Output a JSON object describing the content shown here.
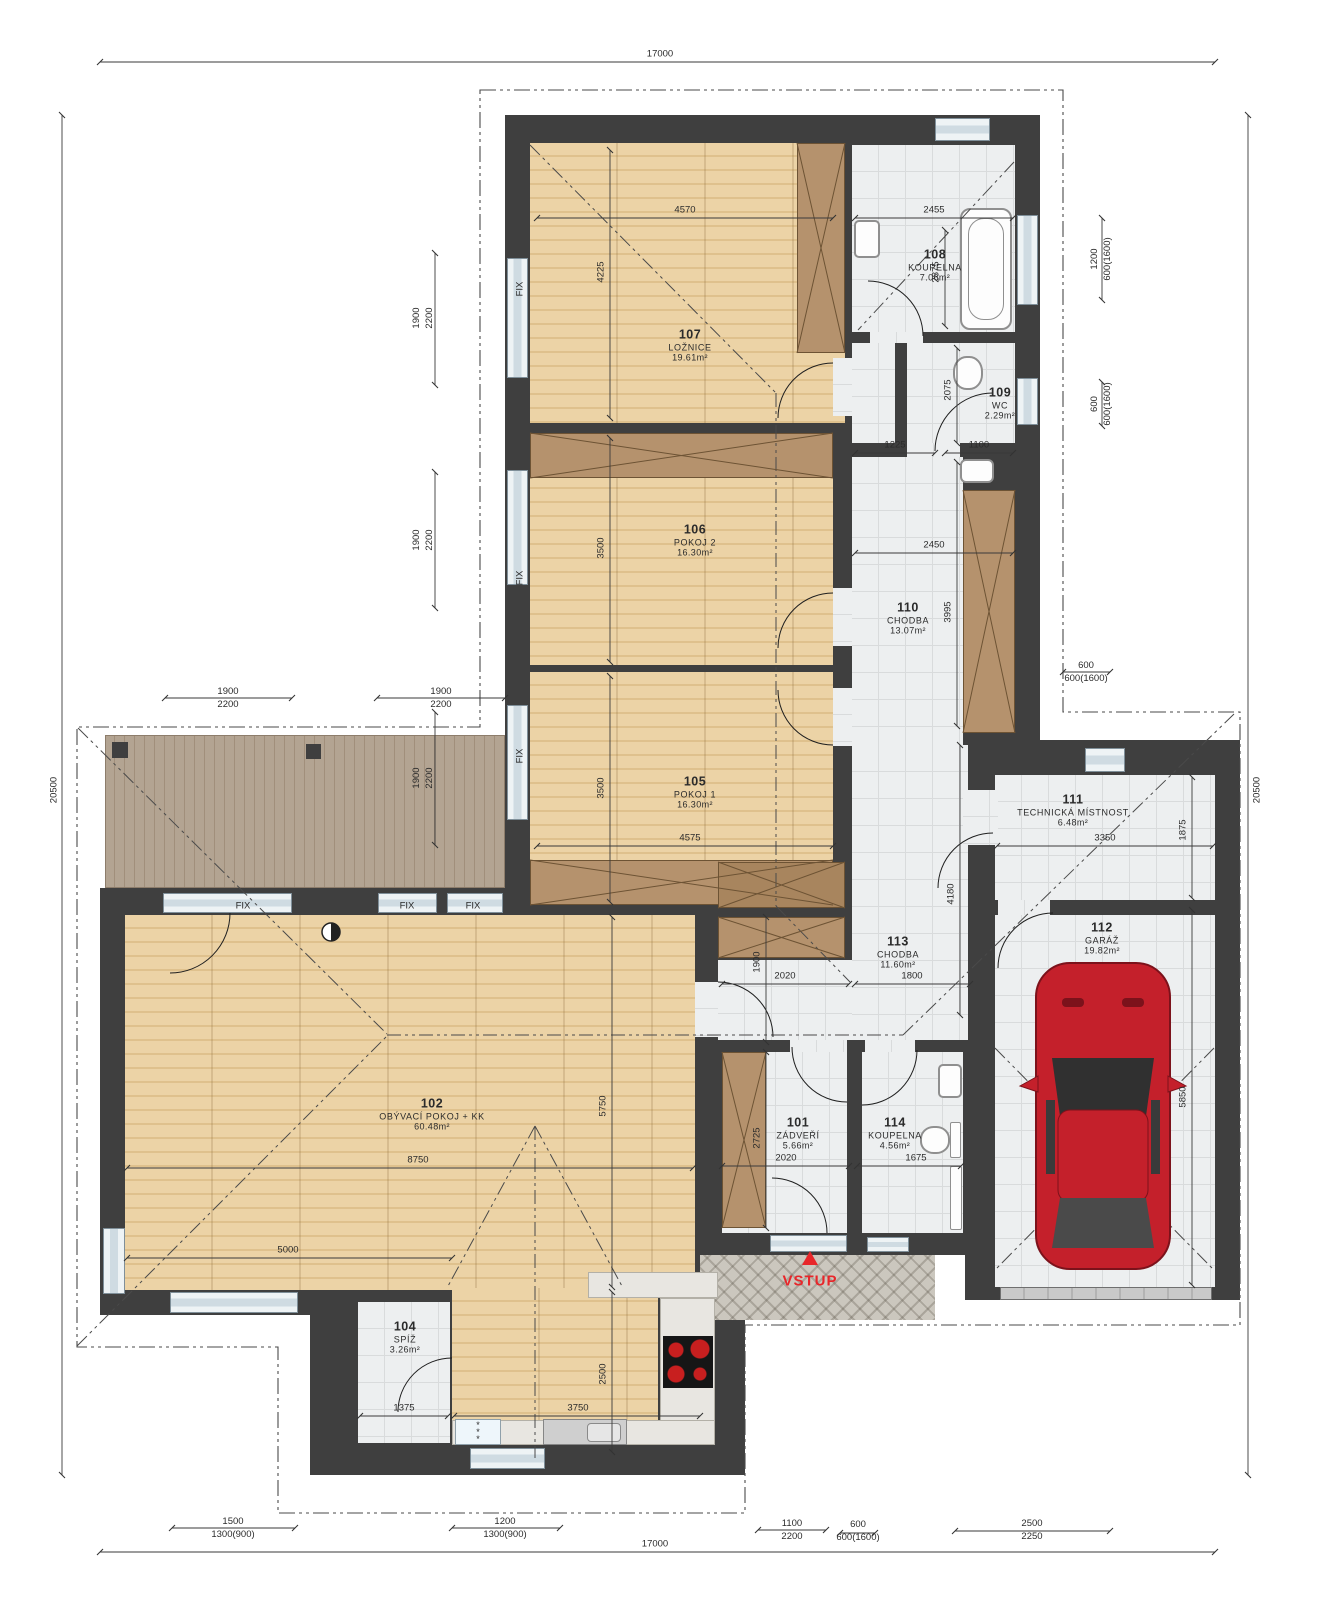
{
  "labels": {
    "fix": "FIX",
    "entry": "VSTUP",
    "fridge": "* * *"
  },
  "rooms": [
    {
      "num": "101",
      "name": "ZÁDVEŘÍ",
      "area": "5.66m²"
    },
    {
      "num": "102",
      "name": "OBÝVACÍ POKOJ + KK",
      "area": "60.48m²"
    },
    {
      "num": "104",
      "name": "SPÍŽ",
      "area": "3.26m²"
    },
    {
      "num": "105",
      "name": "POKOJ 1",
      "area": "16.30m²"
    },
    {
      "num": "106",
      "name": "POKOJ 2",
      "area": "16.30m²"
    },
    {
      "num": "107",
      "name": "LOŽNICE",
      "area": "19.61m²"
    },
    {
      "num": "108",
      "name": "KOUPELNA",
      "area": "7.06m²"
    },
    {
      "num": "109",
      "name": "WC",
      "area": "2.29m²"
    },
    {
      "num": "110",
      "name": "CHODBA",
      "area": "13.07m²"
    },
    {
      "num": "111",
      "name": "TECHNICKÁ MÍSTNOST",
      "area": "6.48m²"
    },
    {
      "num": "112",
      "name": "GARÁŽ",
      "area": "19.82m²"
    },
    {
      "num": "113",
      "name": "CHODBA",
      "area": "11.60m²"
    },
    {
      "num": "114",
      "name": "KOUPELNA",
      "area": "4.56m²"
    }
  ],
  "dims": {
    "overall": {
      "top": "17000",
      "bottom": "17000",
      "left": "20500",
      "right": "20500"
    },
    "interior": [
      "4570",
      "4225",
      "2455",
      "2875",
      "2075",
      "1225",
      "1100",
      "3500",
      "2450",
      "3995",
      "3500",
      "4575",
      "3350",
      "1875",
      "4180",
      "1900",
      "2020",
      "1800",
      "5850",
      "8750",
      "5750",
      "5000",
      "2725",
      "2020",
      "1675",
      "1375",
      "3750",
      "2500"
    ],
    "stacked": [
      {
        "a": "1900",
        "b": "2200"
      },
      {
        "a": "1900",
        "b": "2200"
      },
      {
        "a": "1900",
        "b": "2200"
      },
      {
        "a": "1900",
        "b": "2200"
      },
      {
        "a": "1900",
        "b": "2200"
      },
      {
        "a": "1200",
        "b": "600(1600)"
      },
      {
        "a": "600",
        "b": "600(1600)"
      },
      {
        "a": "600",
        "b": "600(1600)"
      },
      {
        "a": "1500",
        "b": "1300(900)"
      },
      {
        "a": "1200",
        "b": "1300(900)"
      },
      {
        "a": "1100",
        "b": "2200"
      },
      {
        "a": "600",
        "b": "600(1600)"
      },
      {
        "a": "2500",
        "b": "2250"
      }
    ]
  },
  "colors": {
    "wall": "#3f3f3f",
    "wood": "#ecd3a6",
    "wood2": "#dfc18d",
    "tile": "#edeff0",
    "tileline": "#d9dbdc",
    "ward": "#b5926d",
    "ward2": "#a8855e",
    "terr": "#b3a492",
    "pav": "#cbc7be",
    "glz": "#cfdbe2",
    "counter": "#e8e6e1",
    "car": "#c4202b",
    "accent": "#e8262a"
  }
}
